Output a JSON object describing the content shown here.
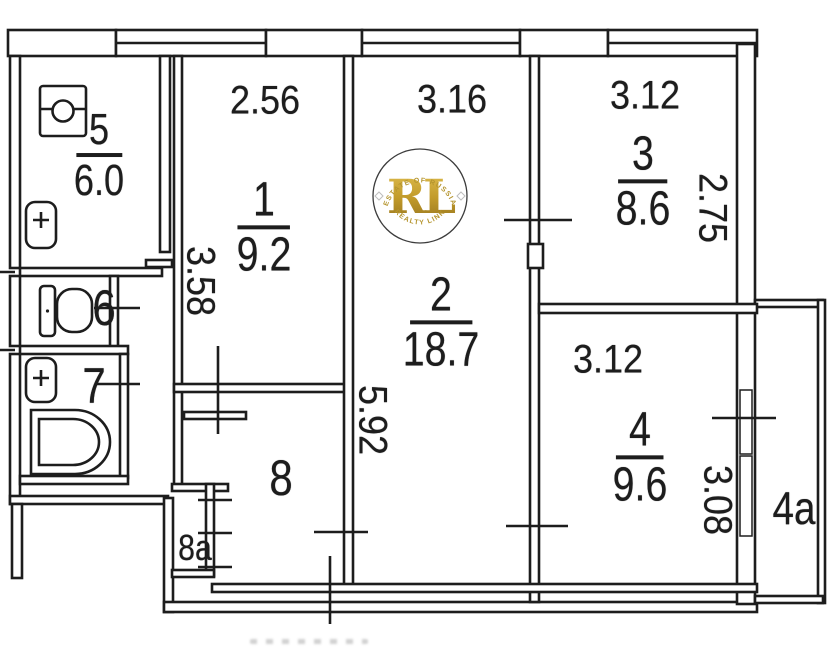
{
  "watermark": {
    "initials": "RL",
    "arc_top": "ESTATE OF RUSSIA",
    "arc_bottom": "REALTY LINK",
    "gold": "#c39a2a"
  },
  "rooms": {
    "r1": {
      "number": "1",
      "area": "9.2",
      "width_m": "2.56",
      "depth_m": "3.58"
    },
    "r2": {
      "number": "2",
      "area": "18.7",
      "width_m": "3.16",
      "depth_m": "5.92"
    },
    "r3": {
      "number": "3",
      "area": "8.6",
      "width_m": "3.12",
      "depth_m": "2.75"
    },
    "r4": {
      "number": "4",
      "area": "9.6",
      "width_m": "3.12",
      "depth_m": "3.08"
    },
    "r5": {
      "number": "5",
      "area": "6.0"
    },
    "r6": {
      "number": "6"
    },
    "r7": {
      "number": "7"
    },
    "r8": {
      "number": "8"
    },
    "r8a": {
      "number": "8a"
    },
    "r4a": {
      "number": "4a"
    }
  },
  "colors": {
    "ink": "#1d1d1d",
    "paper": "#ffffff",
    "gold": "#c39a2a"
  }
}
